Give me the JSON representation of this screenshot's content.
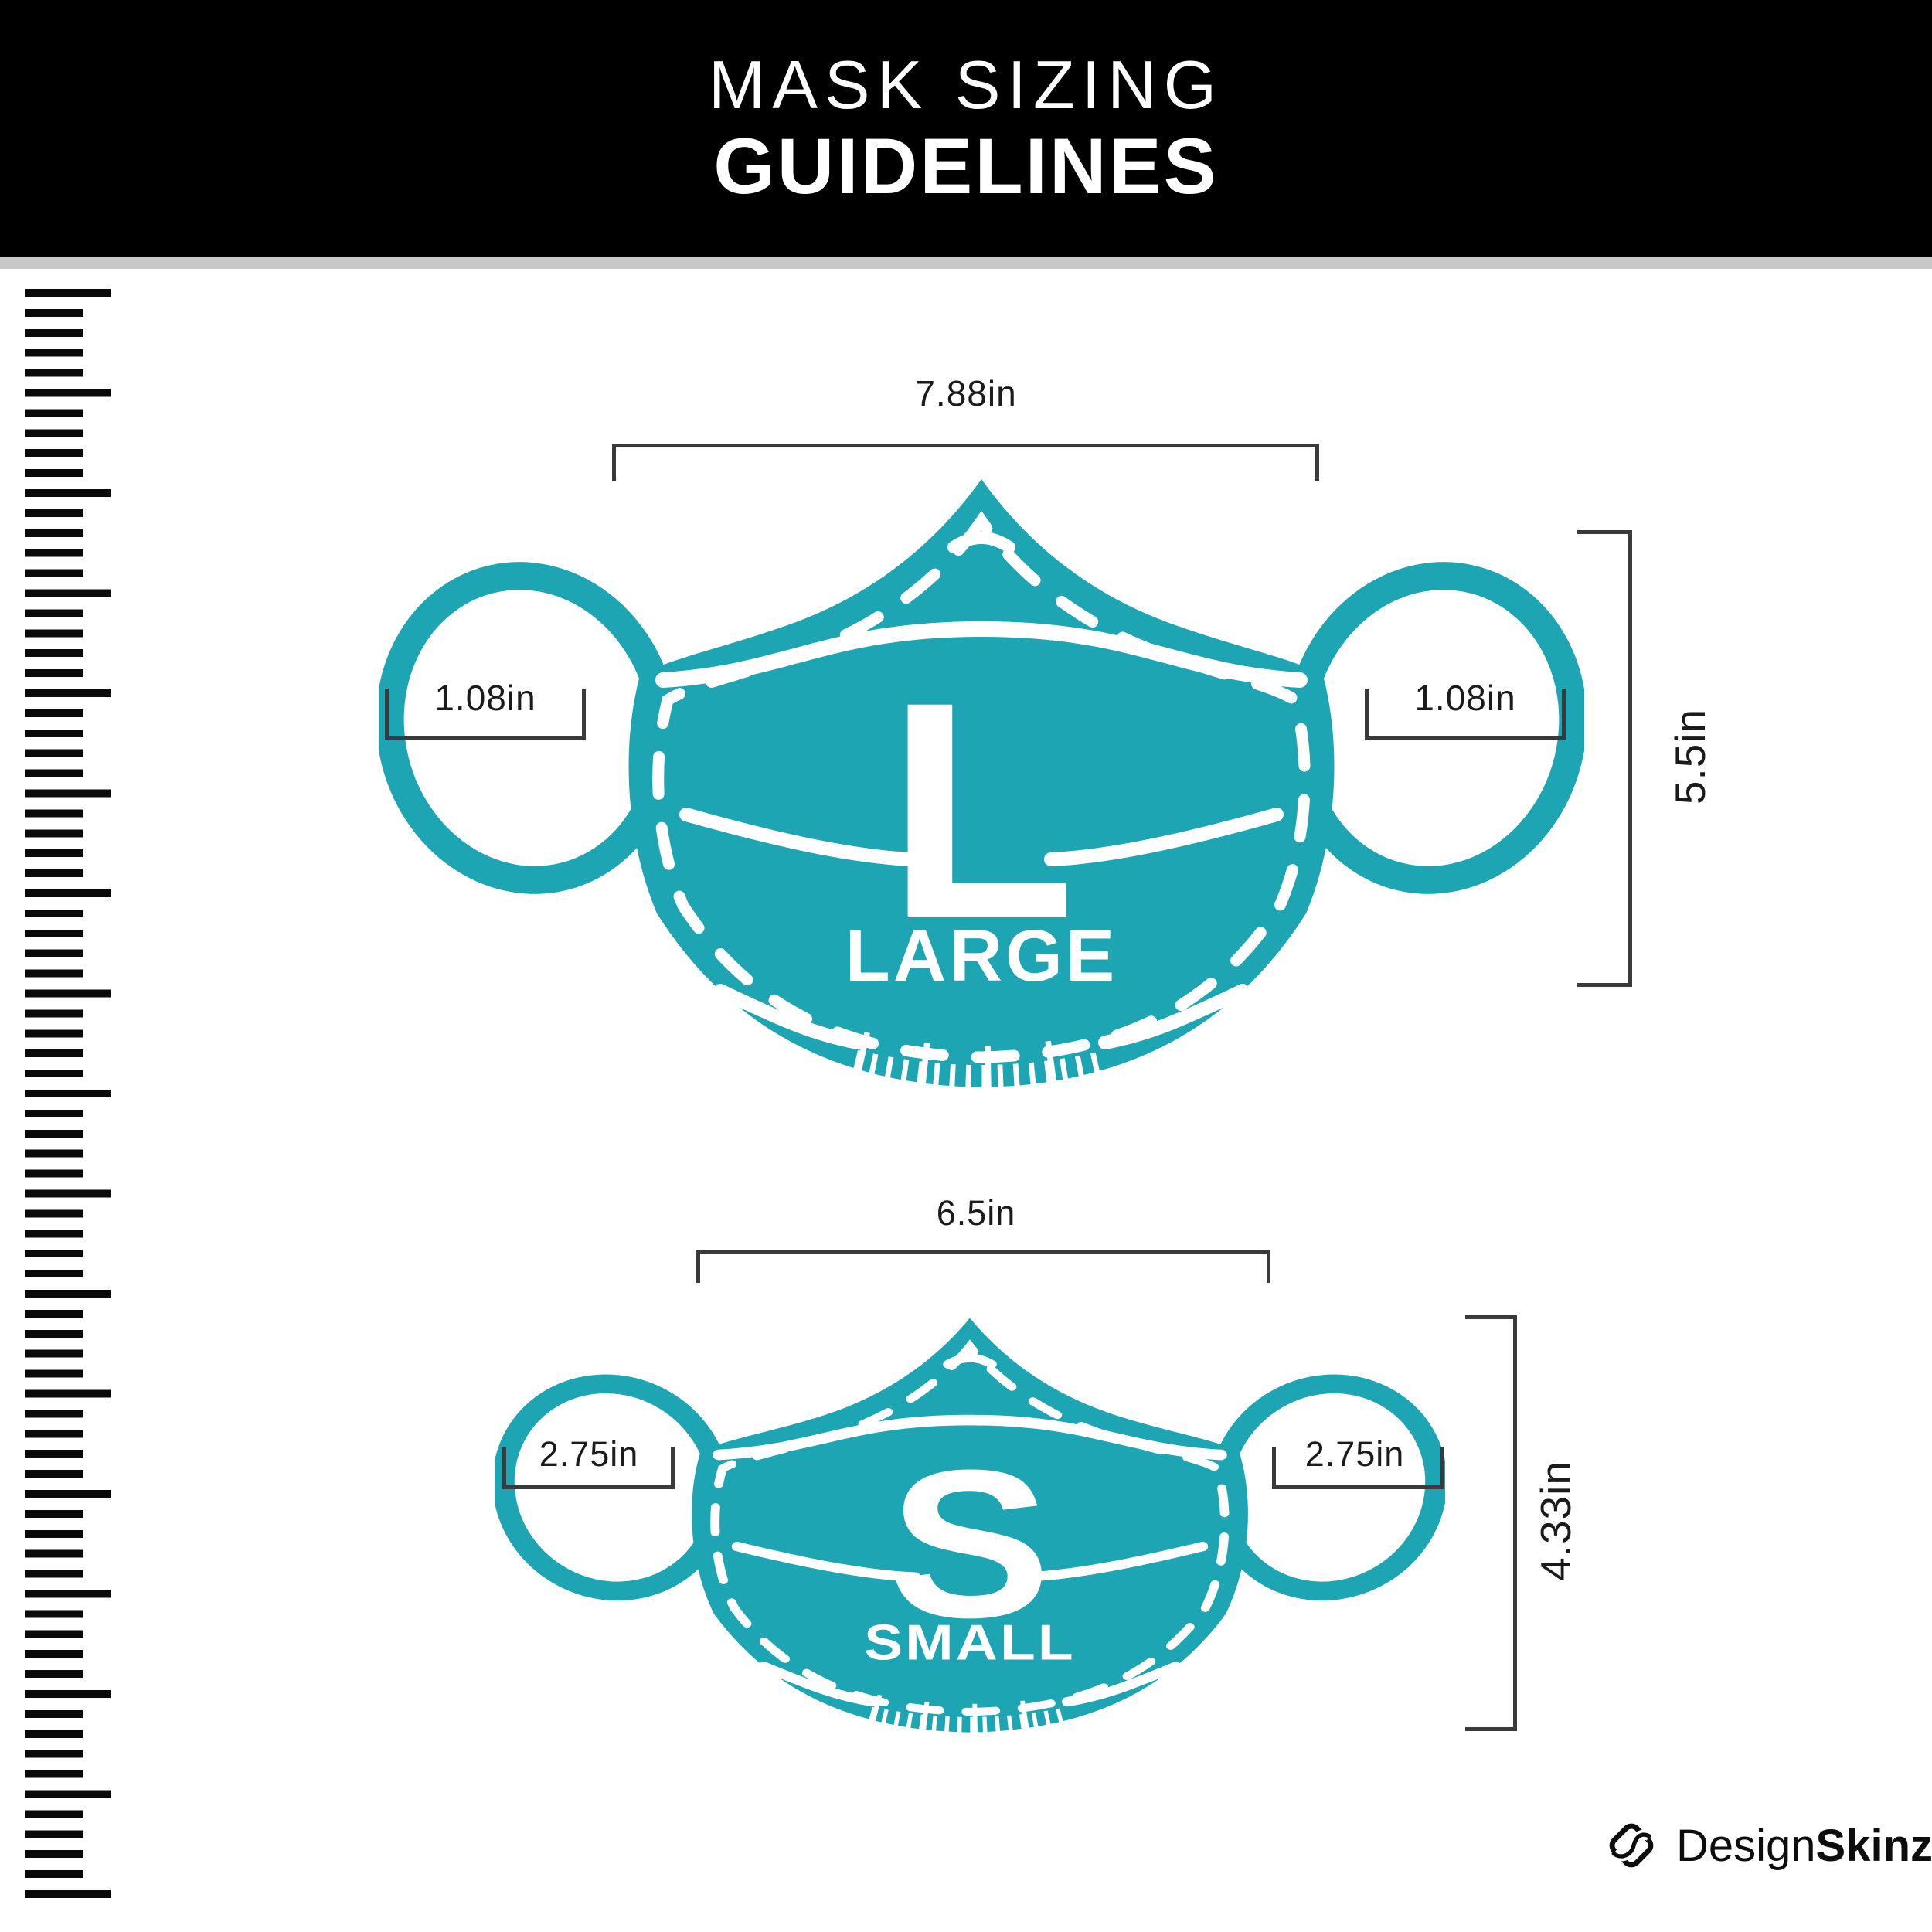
{
  "header": {
    "title_line1": "MASK SIZING",
    "title_line2": "GUIDELINES"
  },
  "masks": [
    {
      "id": "large",
      "letter": "L",
      "size_word": "LARGE",
      "width_label": "7.88in",
      "height_label": "5.5in",
      "ear_left_label": "1.08in",
      "ear_right_label": "1.08in"
    },
    {
      "id": "small",
      "letter": "S",
      "size_word": "SMALL",
      "width_label": "6.5in",
      "height_label": "4.33in",
      "ear_left_label": "2.75in",
      "ear_right_label": "2.75in"
    }
  ],
  "footer": {
    "brand_regular": "Design",
    "brand_bold": "Skinz"
  },
  "colors": {
    "mask_teal": "#1EA5B3",
    "header_bg": "#000000",
    "divider_gray": "#C8C8C8",
    "dimension_line": "#3A3A3A",
    "label_text": "#1B1B1B"
  }
}
